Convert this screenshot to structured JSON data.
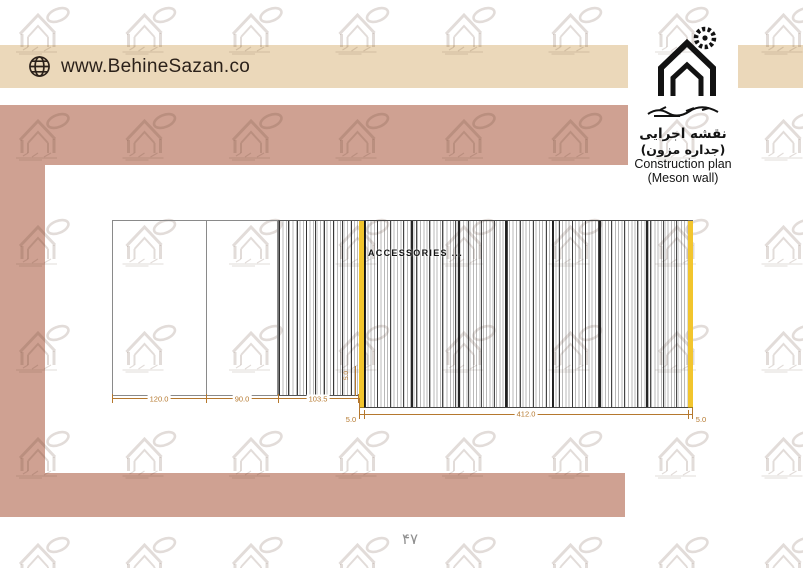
{
  "colors": {
    "beige": "#ebd8ba",
    "salmon": "#cfa192",
    "yellow": "#f2c52d",
    "dim": "#b5782e",
    "ink": "#2b211a"
  },
  "header": {
    "url": "www.BehineSazan.co",
    "globe_icon": "globe"
  },
  "brand": {
    "logo_icon": "house-with-gear",
    "title_fa": "نقشه اجرایی",
    "subtitle_fa": "(جداره مزون)",
    "title_en": "Construction plan",
    "subtitle_en": "(Meson wall)"
  },
  "drawing": {
    "annotation": "ACCESSORIES ...",
    "dims": {
      "panel1": "120.0",
      "panel2": "90.0",
      "panel3": "103.5",
      "left_strip": "5.0",
      "main_panel": "412.0",
      "right_strip": "5.0",
      "vertical": "5.0"
    }
  },
  "footer": {
    "page_number": "۴۷"
  }
}
